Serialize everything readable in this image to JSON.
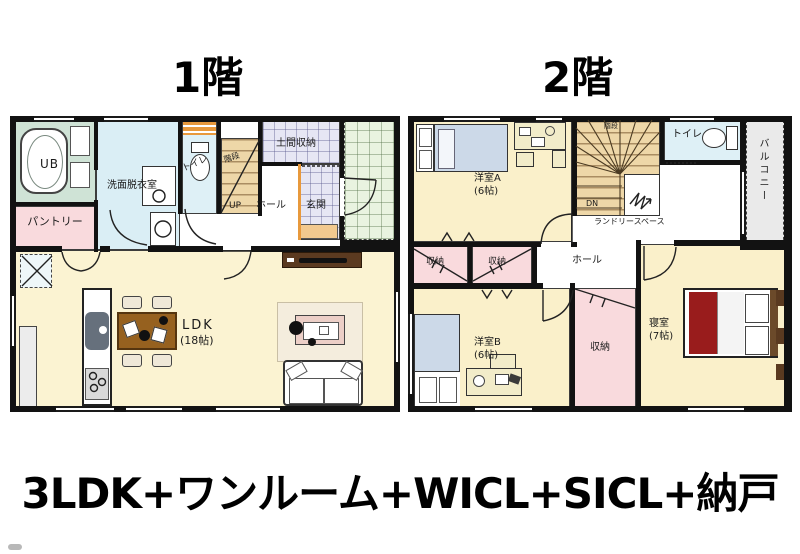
{
  "caption": "3LDK+ワンルーム+WICL+SICL+納戸",
  "floor1": {
    "title": "1階",
    "labels": {
      "bath": "UB",
      "washroom": "洗面脱衣室",
      "pantry": "パントリー",
      "toilet": "トイレ",
      "stairs": "階段",
      "stairs_dir": "UP",
      "doma_storage": "土間収納",
      "hall": "ホール",
      "entrance": "玄関",
      "ldk": "LDK",
      "ldk_size": "(18帖)"
    }
  },
  "floor2": {
    "title": "2階",
    "labels": {
      "room_a": "洋室A",
      "room_a_size": "(6帖)",
      "stairs": "階段",
      "stairs_dir": "DN",
      "laundry": "ランドリースペース",
      "toilet": "トイレ",
      "balcony": "バルコニー",
      "closet_left": "収納",
      "closet_mid": "収納",
      "hall": "ホール",
      "room_b": "洋室B",
      "room_b_size": "(6帖)",
      "storage": "収納",
      "bedroom": "寝室",
      "bedroom_size": "(7帖)"
    }
  },
  "colors": {
    "wall": "#121212",
    "bath": "#cfe3d6",
    "washroom": "#daeef5",
    "toilet": "#def0f6",
    "pantry_closet": "#f9dadd",
    "stairs": "#eed7a8",
    "tile_lavender": "#e6e6f4",
    "tile_green": "#e9f3e0",
    "ldk": "#fbf3d2",
    "room_cream": "#faf0ca",
    "balcony": "#eaeaea",
    "table_brown": "#96611f",
    "tv_board": "#5b3a20",
    "bed_red": "#991c1c",
    "bed_blue": "#ccd9e8",
    "accent_orange": "#e8993c"
  }
}
